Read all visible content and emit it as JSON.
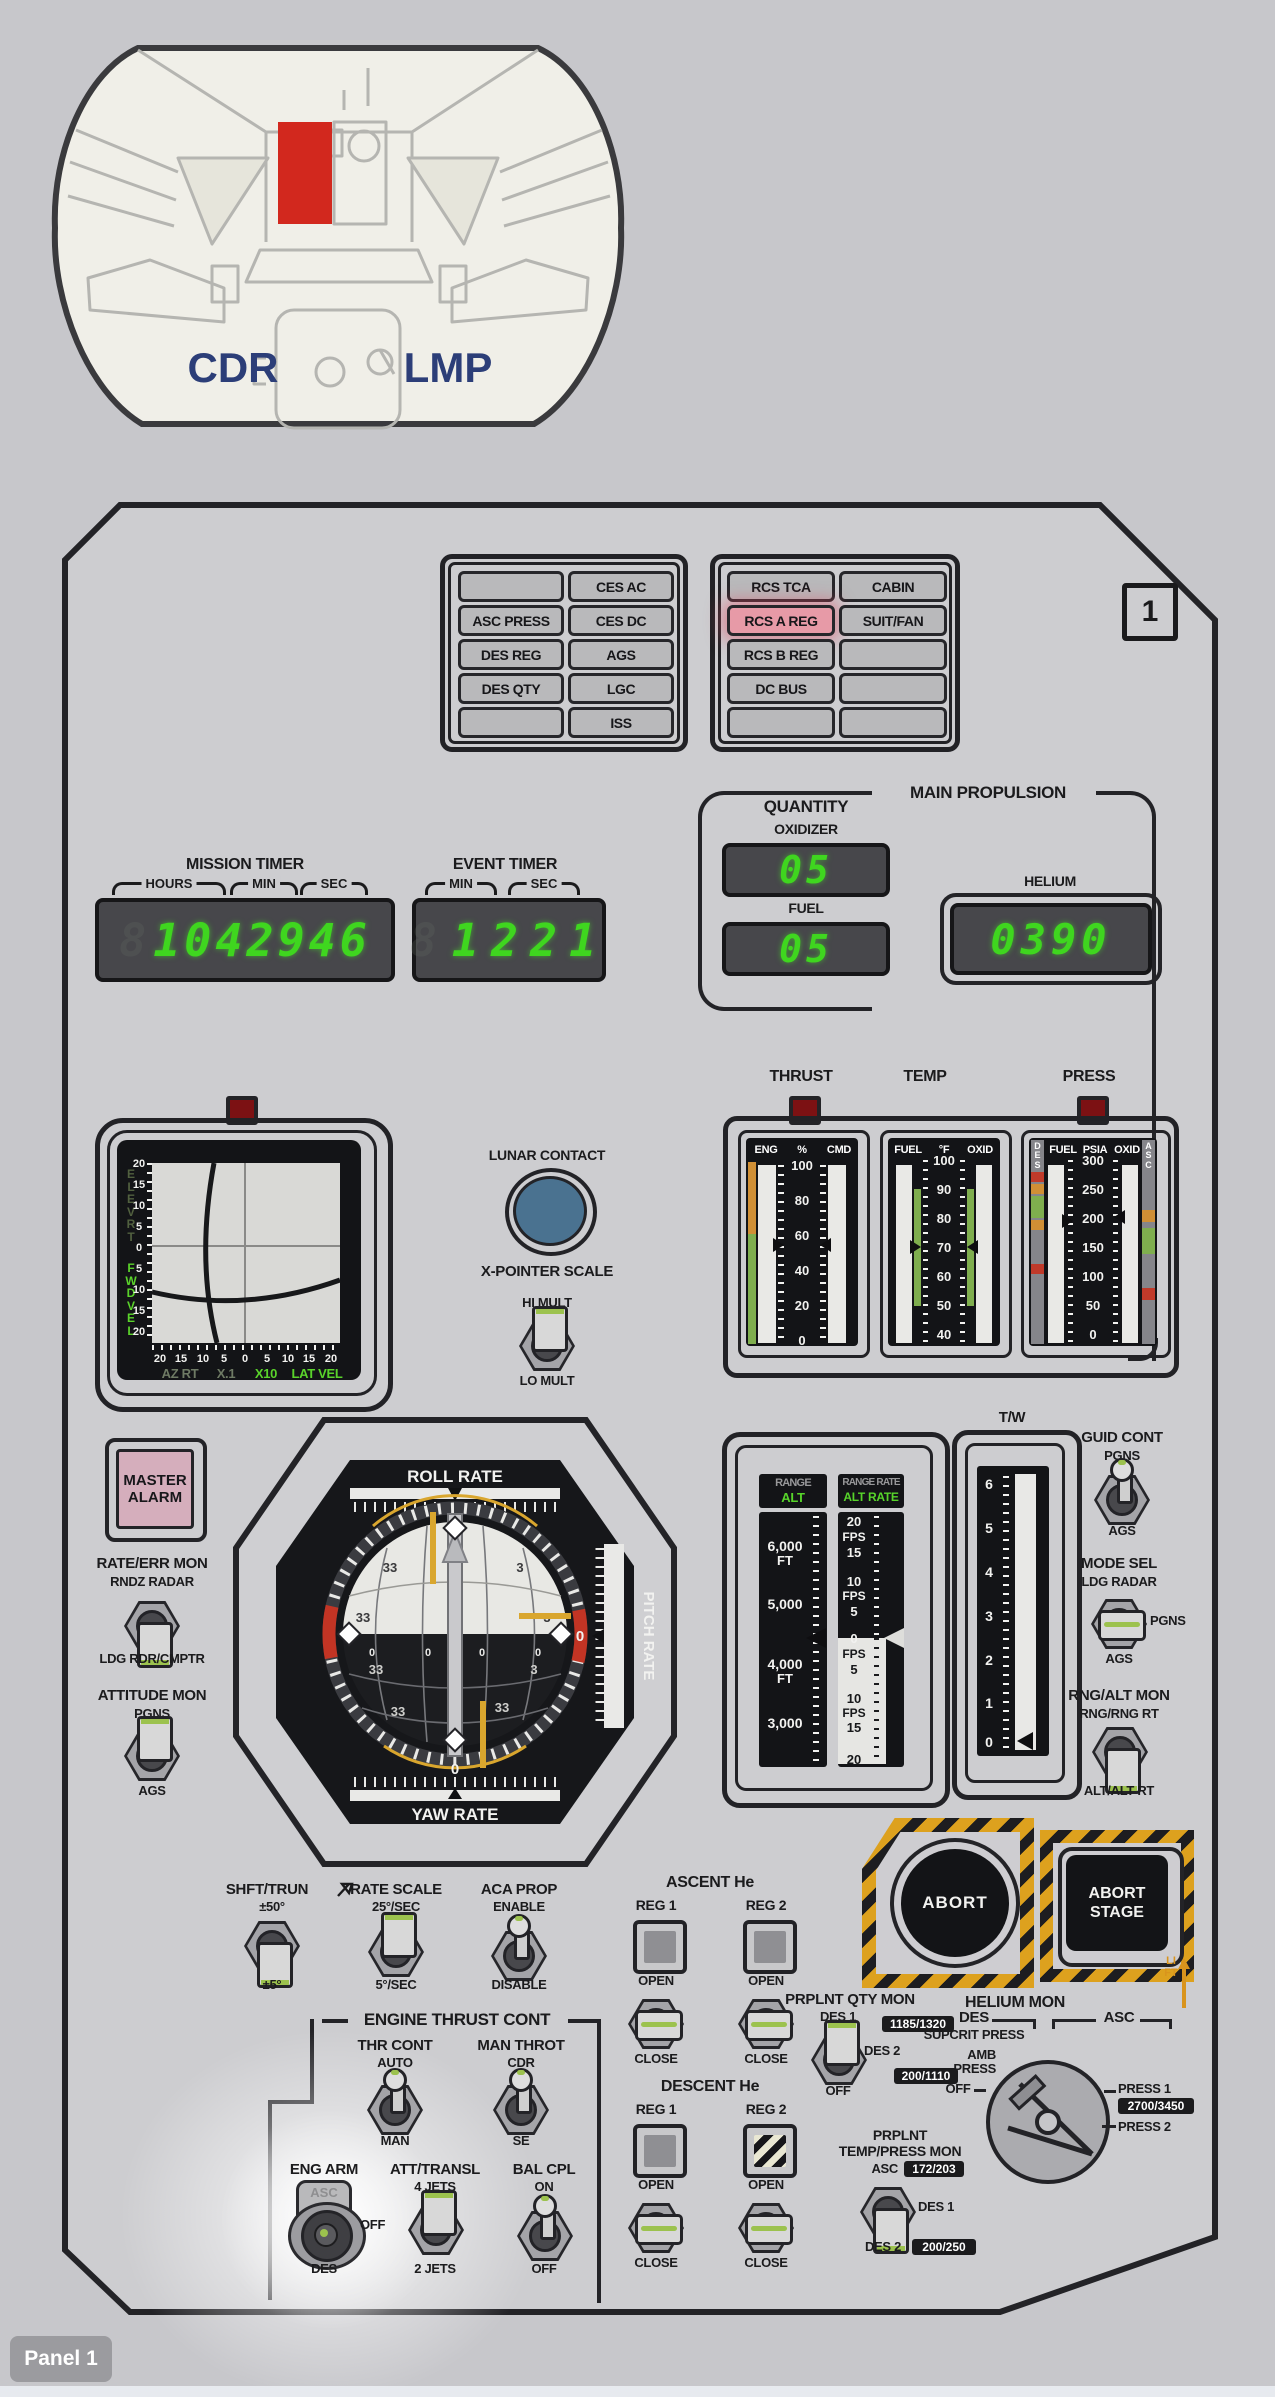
{
  "diagram": {
    "cdr": "CDR",
    "lmp": "LMP"
  },
  "panel_number": "1",
  "footer": "Panel 1",
  "warning": {
    "left": [
      "",
      "CES AC",
      "ASC PRESS",
      "CES DC",
      "DES REG",
      "AGS",
      "DES QTY",
      "LGC",
      "",
      "ISS"
    ],
    "right": [
      "RCS TCA",
      "CABIN",
      "RCS A REG",
      "SUIT/FAN",
      "RCS B REG",
      "",
      "DC BUS",
      "",
      "",
      ""
    ]
  },
  "mission_timer": {
    "title": "MISSION TIMER",
    "hours": "HOURS",
    "min": "MIN",
    "sec": "SEC",
    "value": "1042946"
  },
  "event_timer": {
    "title": "EVENT TIMER",
    "min": "MIN",
    "sec": "SEC",
    "value": "1221"
  },
  "main_prop": {
    "title": "MAIN PROPULSION",
    "quantity": "QUANTITY",
    "oxidizer": "OXIDIZER",
    "oxidizer_value": "05",
    "fuel": "FUEL",
    "fuel_value": "05",
    "helium": "HELIUM",
    "helium_value": "0390"
  },
  "thrust": {
    "title": "THRUST",
    "c1": "ENG",
    "c2": "%",
    "c3": "CMD",
    "ticks": [
      "100",
      "80",
      "60",
      "40",
      "20",
      "0"
    ]
  },
  "temp": {
    "title": "TEMP",
    "c1": "FUEL",
    "c2": "°F",
    "c3": "OXID",
    "ticks": [
      "100",
      "90",
      "80",
      "70",
      "60",
      "50",
      "40"
    ]
  },
  "press": {
    "title": "PRESS",
    "c1": "FUEL",
    "c2": "PSIA",
    "c3": "OXID",
    "des": "DES",
    "asc": "ASC",
    "ticks": [
      "300",
      "250",
      "200",
      "150",
      "100",
      "50",
      "0"
    ]
  },
  "xpointer": {
    "elev": "ELEV RT",
    "fwd": "FWD VEL",
    "scale": [
      "20",
      "15",
      "10",
      "5",
      "0",
      "5",
      "10",
      "15",
      "20"
    ],
    "az_rt": "AZ RT",
    "x1": "X.1",
    "x10": "X10",
    "lat_vel": "LAT VEL"
  },
  "lunar_contact": "LUNAR CONTACT",
  "xp_scale": {
    "title": "X-POINTER SCALE",
    "top": "HI MULT",
    "bottom": "LO MULT"
  },
  "fdai": {
    "roll": "ROLL RATE",
    "yaw": "YAW RATE",
    "pitch": "PITCH RATE",
    "zero": "0",
    "n33": "33",
    "n3": "3"
  },
  "master_alarm": "MASTER ALARM",
  "rate_err": {
    "title": "RATE/ERR MON",
    "top": "RNDZ RADAR",
    "bottom": "LDG RDR/CMPTR"
  },
  "att_mon": {
    "title": "ATTITUDE MON",
    "top": "PGNS",
    "bottom": "AGS"
  },
  "tapes": {
    "range": "RANGE",
    "alt": "ALT",
    "range_rate": "RANGE RATE",
    "alt_rate": "ALT RATE",
    "alt_labels": [
      "6,000",
      "FT",
      "5,000",
      "4,000",
      "FT",
      "3,000"
    ],
    "rate_upper": [
      "20",
      "FPS",
      "15",
      "10",
      "FPS",
      "5",
      "0"
    ],
    "rate_lower": [
      "FPS",
      "5",
      "10",
      "FPS",
      "15",
      "20"
    ]
  },
  "tw": {
    "title": "T/W",
    "ticks": [
      "6",
      "5",
      "4",
      "3",
      "2",
      "1",
      "0"
    ]
  },
  "guid_cont": {
    "title": "GUID CONT",
    "top": "PGNS",
    "bottom": "AGS"
  },
  "mode_sel": {
    "title": "MODE SEL",
    "top": "LDG RADAR",
    "right": "PGNS",
    "bottom": "AGS"
  },
  "rng_alt": {
    "title": "RNG/ALT MON",
    "top": "RNG/RNG RT",
    "bottom": "ALT/ALT RT"
  },
  "shft_trun": {
    "title": "SHFT/TRUN",
    "top": "±50°",
    "bottom": "±5°"
  },
  "rate_scale": {
    "title": "RATE SCALE",
    "top": "25°/SEC",
    "bottom": "5°/SEC"
  },
  "aca_prop": {
    "title": "ACA PROP",
    "top": "ENABLE",
    "bottom": "DISABLE"
  },
  "etc": {
    "title": "ENGINE THRUST CONT",
    "thr_cont": {
      "title": "THR CONT",
      "top": "AUTO",
      "bottom": "MAN"
    },
    "man_throt": {
      "title": "MAN THROT",
      "top": "CDR",
      "bottom": "SE"
    },
    "eng_arm": {
      "title": "ENG ARM",
      "asc": "ASC",
      "off": "OFF",
      "des": "DES"
    },
    "att_transl": {
      "title": "ATT/TRANSL",
      "top": "4 JETS",
      "bottom": "2 JETS"
    },
    "bal_cpl": {
      "title": "BAL CPL",
      "top": "ON",
      "bottom": "OFF"
    }
  },
  "asc_he": {
    "title": "ASCENT He",
    "reg1": "REG 1",
    "reg2": "REG 2",
    "open": "OPEN",
    "close": "CLOSE"
  },
  "des_he": {
    "title": "DESCENT He",
    "reg1": "REG 1",
    "reg2": "REG 2",
    "open": "OPEN",
    "close": "CLOSE"
  },
  "qty_mon": {
    "title": "PRPLNT QTY MON",
    "des1": "DES 1",
    "des2": "DES 2",
    "off": "OFF"
  },
  "helium_mon": {
    "title": "HELIUM MON",
    "des": "DES",
    "asc": "ASC",
    "des_badge": "1185/1320",
    "supcrit": "SUPCRIT PRESS",
    "amb1": "AMB",
    "amb2": "PRESS",
    "amb_badge": "200/1110",
    "off": "OFF",
    "press1": "PRESS 1",
    "press1_badge": "2700/3450",
    "press2": "PRESS 2"
  },
  "tp_mon": {
    "title1": "PRPLNT",
    "title2": "TEMP/PRESS MON",
    "asc": "ASC",
    "asc_badge": "172/203",
    "des1": "DES 1",
    "des2": "DES 2",
    "des2_badge": "200/250"
  },
  "abort": {
    "abort": "ABORT",
    "stage": "ABORT STAGE",
    "lift": "LIFT"
  }
}
